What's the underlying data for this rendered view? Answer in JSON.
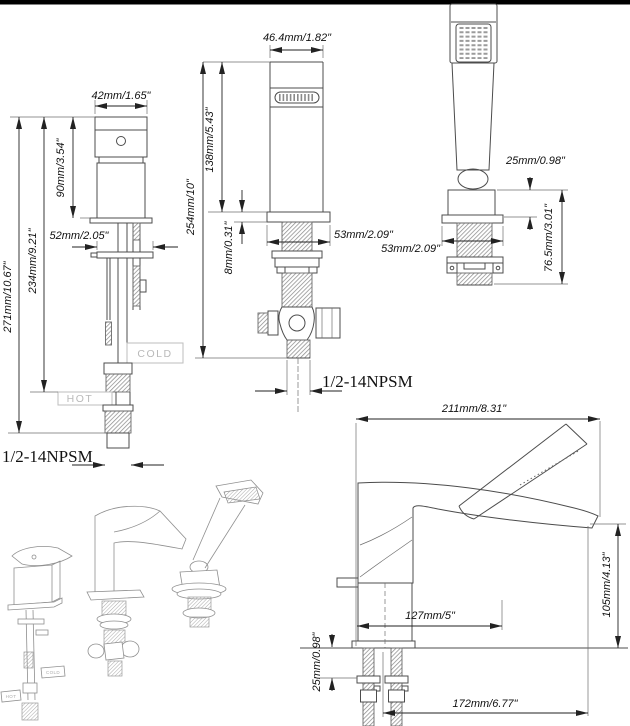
{
  "figures": {
    "valve_front": {
      "dim_width_top": "42mm/1.65\"",
      "dim_handle_height": "90mm/3.54\"",
      "dim_deck_plate_width": "52mm/2.05\"",
      "dim_height_to_hot": "234mm/9.21\"",
      "dim_height_total": "271mm/10.67\"",
      "cold_tag": "COLD",
      "hot_tag": "HOT",
      "thread_spec": "1/2-14NPSM"
    },
    "spout_front": {
      "dim_width_top": "46.4mm/1.82\"",
      "dim_body_height": "138mm/5.43\"",
      "dim_height_total": "254mm/10\"",
      "dim_flange_thickness": "8mm/0.31\"",
      "dim_flange_width": "53mm/2.09\"",
      "thread_spec": "1/2-14NPSM"
    },
    "hand_shower_front": {
      "dim_base_height": "25mm/0.98\"",
      "dim_flange_width": "53mm/2.09\"",
      "dim_under_deck_length": "76.5mm/3.01\""
    },
    "assembled_view": {
      "dim_overall_length": "211mm/8.31\"",
      "dim_spout_height": "105mm/4.13\"",
      "dim_body_length": "127mm/5\"",
      "dim_deck_offset": "25mm/0.98\"",
      "dim_reach": "172mm/6.77\""
    },
    "iso_view": {
      "cold_tag": "COLD",
      "hot_tag": "HOT"
    }
  },
  "colors": {
    "top_bar": "#000000",
    "line": "#4c4c4c",
    "dim_text": "#111111",
    "tag_text": "#b9b9b9",
    "background": "#ffffff"
  }
}
